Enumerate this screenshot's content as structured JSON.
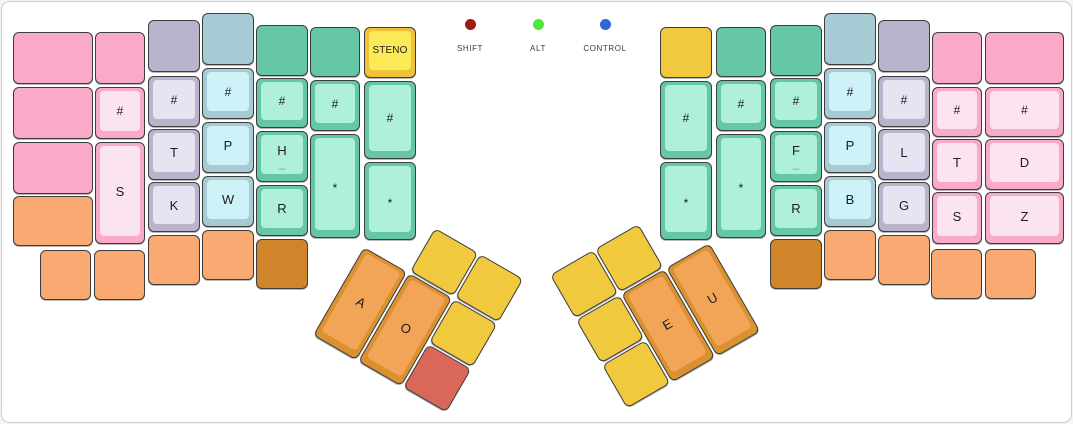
{
  "legend": {
    "items": [
      {
        "label": "SHIFT",
        "color": "#9d1b0f",
        "center_x": 468
      },
      {
        "label": "ALT",
        "color": "#4fe83c",
        "center_x": 536
      },
      {
        "label": "CONTROL",
        "color": "#3465d8",
        "center_x": 603
      }
    ]
  },
  "keyboard": {
    "palette": {
      "pink": {
        "base": "#f9aac8",
        "inner": "#fbe3f2"
      },
      "lavender": {
        "base": "#b9b3cc",
        "inner": "#e7e3f3"
      },
      "blue": {
        "base": "#a7cbd5",
        "inner": "#cdf2f7"
      },
      "teal": {
        "base": "#65c7a5",
        "inner": "#aff0da"
      },
      "yellowCap": {
        "base": "#f0c23a",
        "inner": "#fbea58"
      },
      "amber": {
        "base": "#f1c93e",
        "inner": "#f7dc6a"
      },
      "orangeLight": {
        "base": "#f9aa72",
        "inner": "#fbc89e"
      },
      "orangeDark": {
        "base": "#d0852b",
        "inner": "#e09c46"
      },
      "thumbOrange": {
        "base": "#d9922f",
        "inner": "#f2a457"
      },
      "red": {
        "base": "#d9675a",
        "inner": "#e68b80"
      }
    },
    "keys": [
      {
        "name": "lh-outer-row0",
        "color": "pink",
        "x": 11,
        "y": 30,
        "w": 80,
        "h": 52,
        "label": ""
      },
      {
        "name": "lh-outer-row1",
        "color": "pink",
        "x": 11,
        "y": 85,
        "w": 80,
        "h": 52,
        "label": ""
      },
      {
        "name": "lh-outer-row2",
        "color": "pink",
        "x": 11,
        "y": 140,
        "w": 80,
        "h": 52,
        "label": ""
      },
      {
        "name": "lh-outer-row3",
        "color": "orangeLight",
        "x": 11,
        "y": 194,
        "w": 80,
        "h": 50,
        "label": ""
      },
      {
        "name": "lh-bottom-1",
        "color": "orangeLight",
        "x": 38,
        "y": 248,
        "w": 51,
        "h": 50,
        "label": ""
      },
      {
        "name": "lh-col1-row0",
        "color": "pink",
        "x": 93,
        "y": 30,
        "w": 50,
        "h": 52,
        "label": ""
      },
      {
        "name": "key-hash-left-1",
        "color": "pink",
        "x": 93,
        "y": 85,
        "w": 50,
        "h": 52,
        "label": "#"
      },
      {
        "name": "key-s-left",
        "color": "pink",
        "x": 93,
        "y": 140,
        "w": 50,
        "h": 102,
        "label": "S"
      },
      {
        "name": "lh-bottom-2",
        "color": "orangeLight",
        "x": 92,
        "y": 248,
        "w": 51,
        "h": 50,
        "label": ""
      },
      {
        "name": "lh-col2-row0",
        "color": "lavender",
        "x": 146,
        "y": 18,
        "w": 52,
        "h": 52,
        "label": ""
      },
      {
        "name": "key-hash-left-2",
        "color": "lavender",
        "x": 146,
        "y": 74,
        "w": 52,
        "h": 51,
        "label": "#"
      },
      {
        "name": "key-t-left",
        "color": "lavender",
        "x": 146,
        "y": 127,
        "w": 52,
        "h": 51,
        "label": "T"
      },
      {
        "name": "key-k",
        "color": "lavender",
        "x": 146,
        "y": 180,
        "w": 52,
        "h": 50,
        "label": "K"
      },
      {
        "name": "lh-bottom-3",
        "color": "orangeLight",
        "x": 146,
        "y": 233,
        "w": 52,
        "h": 50,
        "label": ""
      },
      {
        "name": "lh-col3-row0",
        "color": "blue",
        "x": 200,
        "y": 11,
        "w": 52,
        "h": 52,
        "label": ""
      },
      {
        "name": "key-hash-left-3",
        "color": "blue",
        "x": 200,
        "y": 66,
        "w": 52,
        "h": 51,
        "label": "#"
      },
      {
        "name": "key-p-left",
        "color": "blue",
        "x": 200,
        "y": 120,
        "w": 52,
        "h": 51,
        "label": "P"
      },
      {
        "name": "key-w",
        "color": "blue",
        "x": 200,
        "y": 174,
        "w": 52,
        "h": 51,
        "label": "W"
      },
      {
        "name": "lh-bottom-4",
        "color": "orangeLight",
        "x": 200,
        "y": 228,
        "w": 52,
        "h": 50,
        "label": ""
      },
      {
        "name": "lh-col4-row0",
        "color": "teal",
        "x": 254,
        "y": 23,
        "w": 52,
        "h": 51,
        "label": ""
      },
      {
        "name": "key-hash-left-4",
        "color": "teal",
        "x": 254,
        "y": 76,
        "w": 52,
        "h": 50,
        "label": "#"
      },
      {
        "name": "key-h",
        "color": "teal",
        "x": 254,
        "y": 129,
        "w": 52,
        "h": 51,
        "label": "H",
        "sub": "_"
      },
      {
        "name": "key-r-left",
        "color": "teal",
        "x": 254,
        "y": 183,
        "w": 52,
        "h": 51,
        "label": "R"
      },
      {
        "name": "lh-bottom-5",
        "color": "orangeDark",
        "x": 254,
        "y": 237,
        "w": 52,
        "h": 50,
        "label": ""
      },
      {
        "name": "lh-col5-row0",
        "color": "teal",
        "x": 308,
        "y": 25,
        "w": 50,
        "h": 50,
        "label": ""
      },
      {
        "name": "key-hash-left-5",
        "color": "teal",
        "x": 308,
        "y": 78,
        "w": 50,
        "h": 51,
        "label": "#"
      },
      {
        "name": "key-star-left-1",
        "color": "teal",
        "x": 308,
        "y": 132,
        "w": 50,
        "h": 104,
        "label": "*"
      },
      {
        "name": "key-steno",
        "color": "yellowCap",
        "x": 362,
        "y": 25,
        "w": 52,
        "h": 51,
        "label": "STENO"
      },
      {
        "name": "key-hash-left-6",
        "color": "teal",
        "x": 362,
        "y": 79,
        "w": 52,
        "h": 78,
        "label": "#"
      },
      {
        "name": "key-star-left-2",
        "color": "teal",
        "x": 362,
        "y": 160,
        "w": 52,
        "h": 78,
        "label": "*"
      },
      {
        "name": "rh-inner-row0",
        "color": "amber",
        "x": 658,
        "y": 25,
        "w": 52,
        "h": 51,
        "label": ""
      },
      {
        "name": "key-hash-right-1",
        "color": "teal",
        "x": 658,
        "y": 79,
        "w": 52,
        "h": 78,
        "label": "#"
      },
      {
        "name": "key-star-right-1",
        "color": "teal",
        "x": 658,
        "y": 160,
        "w": 52,
        "h": 78,
        "label": "*"
      },
      {
        "name": "rh-col1-row0",
        "color": "teal",
        "x": 714,
        "y": 25,
        "w": 50,
        "h": 50,
        "label": ""
      },
      {
        "name": "key-hash-right-2",
        "color": "teal",
        "x": 714,
        "y": 78,
        "w": 50,
        "h": 51,
        "label": "#"
      },
      {
        "name": "key-star-right-2",
        "color": "teal",
        "x": 714,
        "y": 132,
        "w": 50,
        "h": 104,
        "label": "*"
      },
      {
        "name": "rh-col2-row0",
        "color": "teal",
        "x": 768,
        "y": 23,
        "w": 52,
        "h": 51,
        "label": ""
      },
      {
        "name": "key-hash-right-3",
        "color": "teal",
        "x": 768,
        "y": 76,
        "w": 52,
        "h": 50,
        "label": "#"
      },
      {
        "name": "key-f",
        "color": "teal",
        "x": 768,
        "y": 129,
        "w": 52,
        "h": 51,
        "label": "F",
        "sub": "_"
      },
      {
        "name": "key-r-right",
        "color": "teal",
        "x": 768,
        "y": 183,
        "w": 52,
        "h": 51,
        "label": "R"
      },
      {
        "name": "rh-bottom-1",
        "color": "orangeDark",
        "x": 768,
        "y": 237,
        "w": 52,
        "h": 50,
        "label": ""
      },
      {
        "name": "rh-col3-row0",
        "color": "blue",
        "x": 822,
        "y": 11,
        "w": 52,
        "h": 52,
        "label": ""
      },
      {
        "name": "key-hash-right-4",
        "color": "blue",
        "x": 822,
        "y": 66,
        "w": 52,
        "h": 51,
        "label": "#"
      },
      {
        "name": "key-p-right",
        "color": "blue",
        "x": 822,
        "y": 120,
        "w": 52,
        "h": 51,
        "label": "P"
      },
      {
        "name": "key-b",
        "color": "blue",
        "x": 822,
        "y": 174,
        "w": 52,
        "h": 51,
        "label": "B"
      },
      {
        "name": "rh-bottom-2",
        "color": "orangeLight",
        "x": 822,
        "y": 228,
        "w": 52,
        "h": 50,
        "label": ""
      },
      {
        "name": "rh-col4-row0",
        "color": "lavender",
        "x": 876,
        "y": 18,
        "w": 52,
        "h": 52,
        "label": ""
      },
      {
        "name": "key-hash-right-5",
        "color": "lavender",
        "x": 876,
        "y": 74,
        "w": 52,
        "h": 51,
        "label": "#"
      },
      {
        "name": "key-l",
        "color": "lavender",
        "x": 876,
        "y": 127,
        "w": 52,
        "h": 51,
        "label": "L"
      },
      {
        "name": "key-g",
        "color": "lavender",
        "x": 876,
        "y": 180,
        "w": 52,
        "h": 50,
        "label": "G"
      },
      {
        "name": "rh-bottom-3",
        "color": "orangeLight",
        "x": 876,
        "y": 233,
        "w": 52,
        "h": 50,
        "label": ""
      },
      {
        "name": "rh-col5-row0",
        "color": "pink",
        "x": 930,
        "y": 30,
        "w": 50,
        "h": 52,
        "label": ""
      },
      {
        "name": "key-hash-right-6",
        "color": "pink",
        "x": 930,
        "y": 85,
        "w": 50,
        "h": 50,
        "label": "#"
      },
      {
        "name": "key-t-right",
        "color": "pink",
        "x": 930,
        "y": 137,
        "w": 50,
        "h": 51,
        "label": "T"
      },
      {
        "name": "key-s-right",
        "color": "pink",
        "x": 930,
        "y": 190,
        "w": 50,
        "h": 52,
        "label": "S"
      },
      {
        "name": "rh-bottom-4",
        "color": "orangeLight",
        "x": 929,
        "y": 247,
        "w": 51,
        "h": 50,
        "label": ""
      },
      {
        "name": "rh-outer-row0",
        "color": "pink",
        "x": 983,
        "y": 30,
        "w": 79,
        "h": 52,
        "label": ""
      },
      {
        "name": "key-hash-right-7",
        "color": "pink",
        "x": 983,
        "y": 85,
        "w": 79,
        "h": 50,
        "label": "#"
      },
      {
        "name": "key-d",
        "color": "pink",
        "x": 983,
        "y": 137,
        "w": 79,
        "h": 51,
        "label": "D"
      },
      {
        "name": "key-z",
        "color": "pink",
        "x": 983,
        "y": 190,
        "w": 79,
        "h": 52,
        "label": "Z"
      },
      {
        "name": "rh-bottom-5",
        "color": "orangeLight",
        "x": 983,
        "y": 247,
        "w": 51,
        "h": 50,
        "label": ""
      }
    ],
    "thumb_clusters": [
      {
        "name": "left-thumb-cluster",
        "x": 388,
        "y": 200,
        "rotation_deg": 30,
        "keys": [
          {
            "name": "lt-top-1",
            "color": "amber",
            "x": 52,
            "y": 0,
            "w": 50,
            "h": 50,
            "label": ""
          },
          {
            "name": "lt-top-2",
            "color": "amber",
            "x": 104,
            "y": 0,
            "w": 50,
            "h": 50,
            "label": ""
          },
          {
            "name": "key-a",
            "color": "thumbOrange",
            "x": 0,
            "y": 52,
            "w": 50,
            "h": 102,
            "label": "A"
          },
          {
            "name": "key-o",
            "color": "thumbOrange",
            "x": 52,
            "y": 52,
            "w": 50,
            "h": 102,
            "label": "O"
          },
          {
            "name": "lt-side-1",
            "color": "amber",
            "x": 104,
            "y": 52,
            "w": 50,
            "h": 50,
            "label": ""
          },
          {
            "name": "lt-side-2",
            "color": "red",
            "x": 104,
            "y": 104,
            "w": 50,
            "h": 50,
            "label": ""
          }
        ]
      },
      {
        "name": "right-thumb-cluster",
        "x": 548,
        "y": 273,
        "rotation_deg": -30,
        "keys": [
          {
            "name": "rt-top-1",
            "color": "amber",
            "x": 0,
            "y": 0,
            "w": 50,
            "h": 50,
            "label": ""
          },
          {
            "name": "rt-top-2",
            "color": "amber",
            "x": 52,
            "y": 0,
            "w": 50,
            "h": 50,
            "label": ""
          },
          {
            "name": "rt-side-1",
            "color": "amber",
            "x": 0,
            "y": 52,
            "w": 50,
            "h": 50,
            "label": ""
          },
          {
            "name": "rt-side-2",
            "color": "amber",
            "x": 0,
            "y": 104,
            "w": 50,
            "h": 50,
            "label": ""
          },
          {
            "name": "key-e",
            "color": "thumbOrange",
            "x": 52,
            "y": 52,
            "w": 50,
            "h": 102,
            "label": "E"
          },
          {
            "name": "key-u",
            "color": "thumbOrange",
            "x": 104,
            "y": 52,
            "w": 50,
            "h": 102,
            "label": "U"
          }
        ]
      }
    ]
  }
}
